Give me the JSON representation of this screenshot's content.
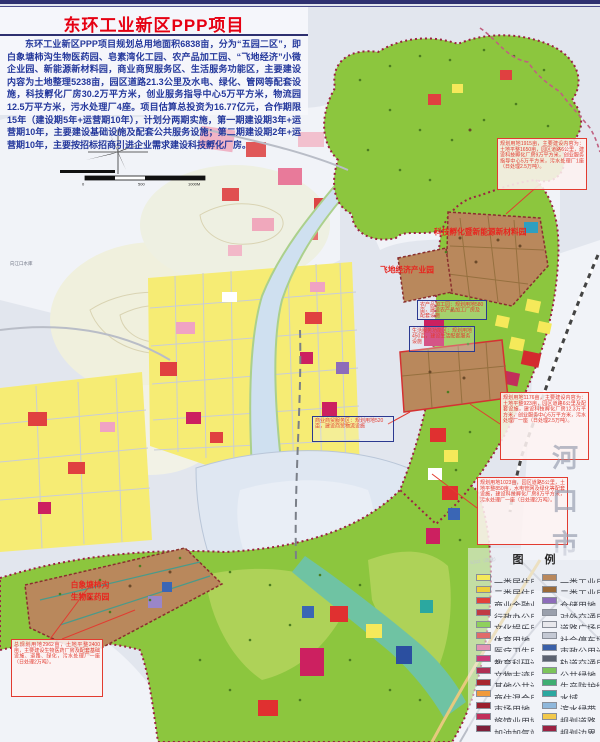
{
  "header": {
    "title": "东环工业新区PPP项目",
    "intro": "东环工业新区PPP项目规划总用地面积6838亩，分为“五园二区”，即白象塘柿沟生物医药园、皂素湾化工园、农产品加工园、“飞地经济”小微企业园、新能源新材料园，商业商贸服务区、生活服务功能区，主要建设内容为土地整理5238亩，园区道路21.3公里及水电、绿化、管网等配套设施，科技孵化厂房30.2万平方米，创业服务指导中心5万平方米，物流园12.5万平方米，污水处理厂4座。项目估算总投资为16.77亿元，合作期限15年（建设期5年+运营期10年），计划分两期实施，第一期建设期3年+运营期10年，主要建设基础设施及配套公共服务设施；第二期建设期2年+运营期10年，主要按招标招商引进企业需求建设科技孵化厂房。"
  },
  "map": {
    "reservoir_label": "向江口水库",
    "city_chars": [
      "河",
      "口",
      "市"
    ],
    "road_label": "S302（改建）",
    "scalebar": {
      "zero": "0",
      "mid": "500",
      "end": "1000M"
    },
    "area_labels": {
      "ne_park": "科技孵化暨新能源新材料园",
      "feidi_park": "飞地经济产业园",
      "bio_park_line1": "白象塘柿沟",
      "bio_park_line2": "生物医药园"
    },
    "red_notes": {
      "ne": "规划用地1915亩，主要建设内容为：土地平整1650亩，园区道路6公里，建设科技孵化厂房9万平方米，创业服务指导中心5万平方米，污水处理厂1座（日处理2.5万吨）。",
      "east": "规划用地1176亩，主要建设内容为：土地平整923亩，园区道路6公里及配套设施，建设科技孵化厂房12.3万平方米，创业服务中心5万平方米，污水处理厂一座（日处理2.5万吨）。",
      "southeast": "规划用地1023亩，园区道路5公里，土地平整850亩，水电管网及绿化等配套设施，建设科技孵化厂房8万平方米，污水处理厂一座（日处理2万吨）。",
      "southwest": "总规划用地2962亩，土地平整2400亩，主要建设生物医药厂房及配套基础设施、道路、绿化，污水处理厂一座（日处理2万吨）。"
    },
    "blue_notes": {
      "n1": "农产品加工园：规划用地580亩，建设农产品加工厂房及配套设施",
      "n2": "生活服务功能区：规划用地450亩，建设生活配套服务设施",
      "n3": "商业商贸服务区：规划用地520亩，建设商贸物流设施"
    },
    "colors": {
      "title_red": "#e60012",
      "intro_blue": "#24389c",
      "park_green": "#8cc63e",
      "industry_brown": "#b9885c",
      "residential_yellow": "#f6ec74",
      "boundary_maroon": "#9b2242",
      "water_blue": "#cfe0f0",
      "river_teal": "#6fc3a3"
    }
  },
  "legend": {
    "title": "图 例",
    "col1": [
      {
        "label": "一类居住用地",
        "color": "#f5e95a"
      },
      {
        "label": "二类居住用地",
        "color": "#efcf3a"
      },
      {
        "label": "商业金融业用地",
        "color": "#e2403c"
      },
      {
        "label": "行政办公用地",
        "color": "#c03a44"
      },
      {
        "label": "文化娱乐用地",
        "color": "#8fd05c"
      },
      {
        "label": "体育用地",
        "color": "#e06a6a"
      },
      {
        "label": "医疗卫生用地",
        "color": "#e292b4"
      },
      {
        "label": "教育科研设计用地",
        "color": "#cc3a78"
      },
      {
        "label": "文物古迹用地",
        "color": "#b03054"
      },
      {
        "label": "其他公共设施用地",
        "color": "#a8262e"
      },
      {
        "label": "商住混合用地",
        "color": "#f09a3c"
      },
      {
        "label": "市场用地",
        "color": "#9a1f2e"
      },
      {
        "label": "旅馆业用地",
        "color": "#c22f5a"
      },
      {
        "label": "加油加气站用地",
        "color": "#7e1f3a"
      }
    ],
    "col2": [
      {
        "label": "一类工业用地",
        "color": "#b9885c"
      },
      {
        "label": "二类工业用地",
        "color": "#9a6a38"
      },
      {
        "label": "仓储用地",
        "color": "#8d6cba"
      },
      {
        "label": "对外交通用地",
        "color": "#9aa0ac"
      },
      {
        "label": "道路广场用地",
        "color": "#e8e8ec"
      },
      {
        "label": "社会停车场库用地",
        "color": "#c4c9d4"
      },
      {
        "label": "市政公用设施用地",
        "color": "#3a5fa8"
      },
      {
        "label": "轨道交通用地",
        "color": "#5b6270"
      },
      {
        "label": "公共绿地",
        "color": "#7cc45a"
      },
      {
        "label": "生产防护绿地",
        "color": "#3fae72"
      },
      {
        "label": "水域",
        "color": "#2ba8a0"
      },
      {
        "label": "滨水绿带",
        "color": "#8fb8dc"
      },
      {
        "label": "规划道路",
        "color": "#f2c94c"
      },
      {
        "label": "规划边界",
        "color": "#9b2242"
      }
    ]
  }
}
